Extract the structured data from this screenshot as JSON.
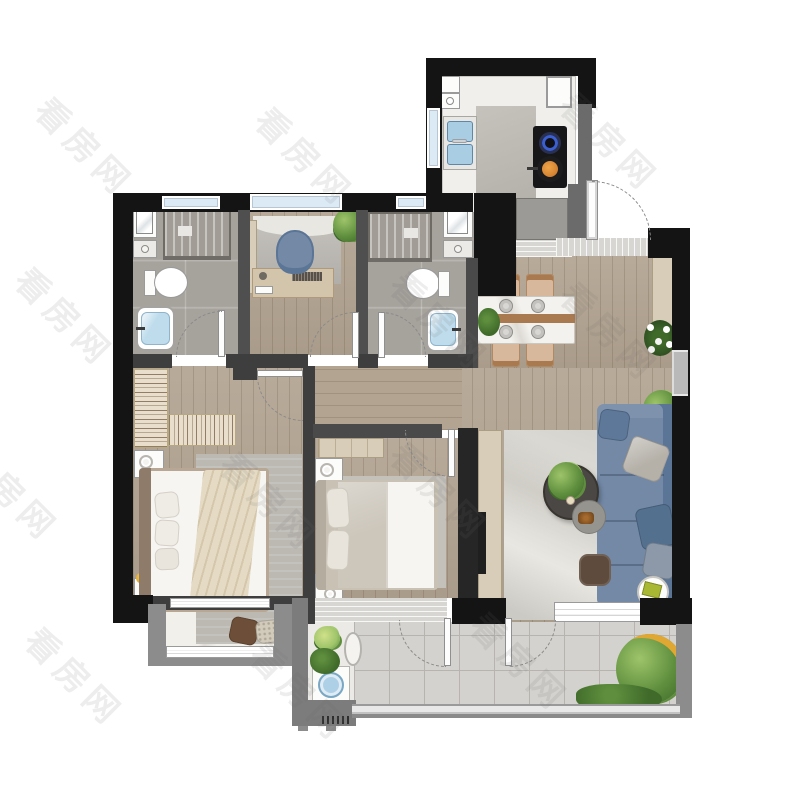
{
  "watermark": {
    "text": "看房网"
  },
  "colors": {
    "bg": "#ffffff",
    "wall_black": "#141414",
    "wall_dark": "#3e3e3e",
    "wall_gray": "#8c8c8c",
    "wood": "#b3a492",
    "bath_floor": "#a6a29c",
    "kitchen_counter": "#f0efec",
    "kitchen_floor": "#b9b5ae",
    "tile": "#d4d2ce",
    "tile_line": "#b7b4b0",
    "nook_floor": "#ebeae6",
    "bay_floor": "#f2f0ea",
    "glass": "#dceaf6",
    "frame_white": "#ffffff",
    "threshold": "#d8d6d2",
    "rug_gray": "#bcb9b3",
    "rug_light": "#e9e7e2",
    "marble_table": "#f4f2ee",
    "wood_accent": "#a97a50",
    "chair_tan": "#d8b89d",
    "sofa": "#7389a6",
    "sofa_dark": "#5b7596",
    "pillow_gray": "#b5b1a9",
    "bed_white": "#f6f5f2",
    "blanket": "#e5dbc4",
    "headboard": "#8e7b69",
    "duvet_gray": "#ccc6bb",
    "wardrobe": "#e8decb",
    "cabinet": "#d8cdb9",
    "plant": "#5f8f3e",
    "plant_dark": "#3f6a2a",
    "plant_light": "#9ec46a",
    "flower_yellow": "#e0a832",
    "tub_blue": "#bfdcec",
    "sink_blue": "#a9cde2",
    "cooktop": "#17171a",
    "burner_blue": "#3c5fd0",
    "wok_orange": "#d4812f",
    "dark_table": "#4a4744",
    "pouf": "#5e4b3d",
    "book_green": "#a8b832",
    "washer_blue": "#aed0e6"
  },
  "plan": {
    "type": "apartment-floor-plan",
    "rooms": [
      "kitchen",
      "bathroom-1",
      "study",
      "bathroom-2",
      "entry",
      "dining",
      "living-room",
      "master-bedroom",
      "second-bedroom",
      "corridor",
      "bay-window",
      "laundry-nook",
      "balcony"
    ]
  }
}
